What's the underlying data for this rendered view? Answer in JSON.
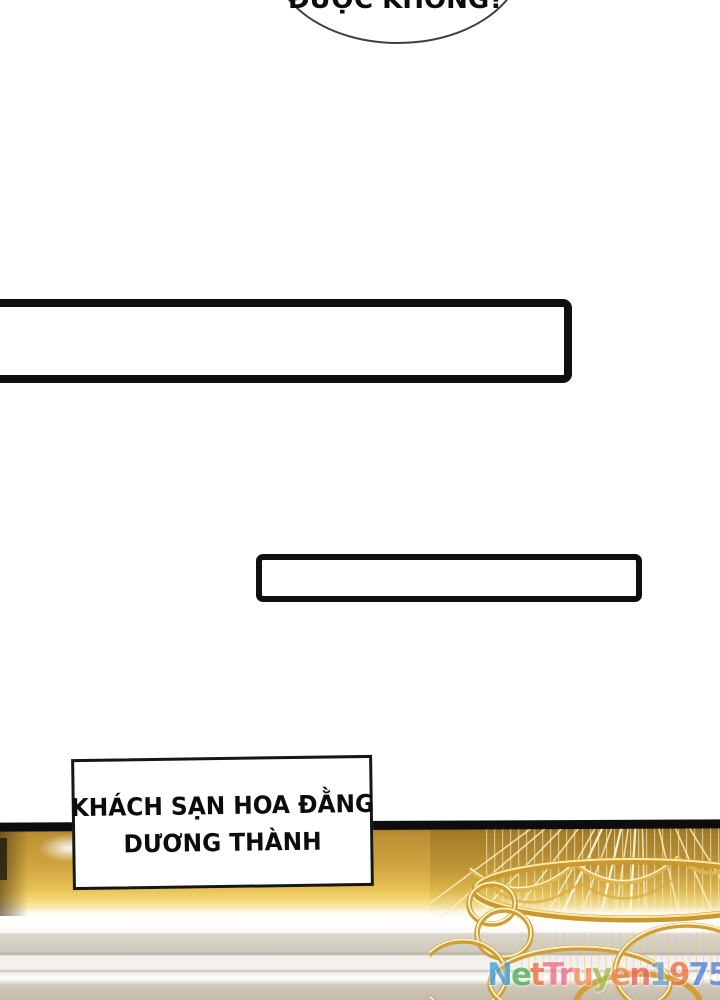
{
  "bubble": {
    "partial_text": "ĐƯỢC KHÔNG?"
  },
  "caption": {
    "line1": "KHÁCH SẠN HOA ĐẰNG",
    "line2": "DƯƠNG THÀNH"
  },
  "watermark": {
    "text": "NetTruyen1975",
    "letters": [
      {
        "ch": "N",
        "color": "#47a0dc"
      },
      {
        "ch": "e",
        "color": "#4fb058"
      },
      {
        "ch": "t",
        "color": "#ef6f45"
      },
      {
        "ch": "T",
        "color": "#ee6e91"
      },
      {
        "ch": "r",
        "color": "#ee6e91"
      },
      {
        "ch": "u",
        "color": "#f28f5b"
      },
      {
        "ch": "y",
        "color": "#a9be52"
      },
      {
        "ch": "e",
        "color": "#f08756"
      },
      {
        "ch": "n",
        "color": "#e96a63"
      },
      {
        "ch": "1",
        "color": "#6ca4d8"
      },
      {
        "ch": "9",
        "color": "#ee7045"
      },
      {
        "ch": "7",
        "color": "#4f86d6"
      },
      {
        "ch": "5",
        "color": "#5f7ed8"
      }
    ]
  },
  "palette": {
    "panel_border": "#0f0f0f",
    "gold_wall": "#d0a440",
    "gold_highlight": "#f6e196",
    "chandelier_gold": "#cf9e35",
    "wall_taupe": "#cfc9bc",
    "bubble_stroke": "#3f3f3f"
  }
}
